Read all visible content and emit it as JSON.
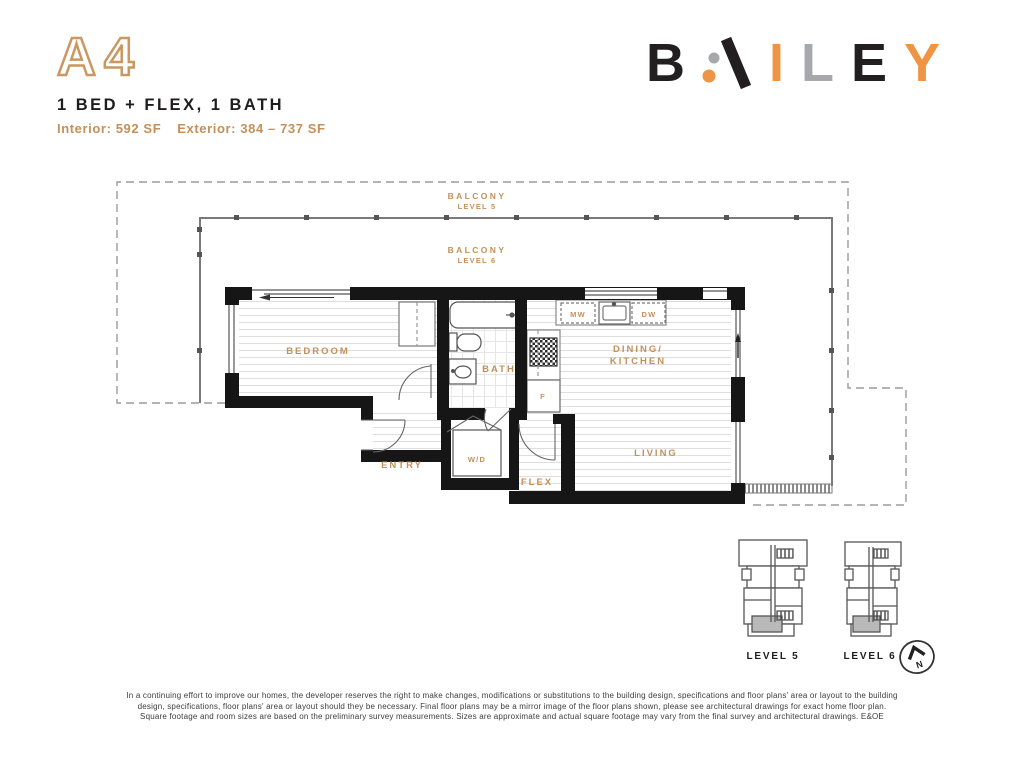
{
  "header": {
    "unit_code": "A4",
    "unit_name": "1 BED + FLEX, 1 BATH",
    "size_interior": "Interior: 592 SF",
    "size_exterior": "Exterior: 384 – 737 SF"
  },
  "logo": {
    "b": "B",
    "a": "A",
    "i": "I",
    "l": "L",
    "e": "E",
    "y": "Y",
    "full_name": "BAILEY"
  },
  "plan": {
    "balcony5_line1": "BALCONY",
    "balcony5_line2": "LEVEL 5",
    "balcony6_line1": "BALCONY",
    "balcony6_line2": "LEVEL 6",
    "bedroom": "BEDROOM",
    "bath": "BATH",
    "dining_line1": "DINING/",
    "dining_line2": "KITCHEN",
    "living": "LIVING",
    "entry": "ENTRY",
    "wd": "W/D",
    "flex": "FLEX",
    "mw": "MW",
    "dw": "DW",
    "fridge": "F"
  },
  "keyplans": {
    "level5": "LEVEL 5",
    "level6": "LEVEL 6",
    "north": "N"
  },
  "disclaimer": {
    "line1": "In a continuing effort to improve our homes, the developer reserves the right to make changes, modifications or substitutions to the building design, specifications and floor plans' area or layout to the building",
    "line2": "design, specifications, floor plans' area or layout should they be necessary. Final floor plans may be a mirror image of the floor plans shown, please see architectural drawings for exact home floor plan.",
    "line3": "Square footage and room sizes are based on the preliminary survey measurements. Sizes are approximate and actual square footage may vary from the final survey and architectural drawings. E&OE"
  },
  "colors": {
    "accent_tan": "#c2915a",
    "logo_orange": "#ee9444",
    "logo_gray": "#a6a8ab",
    "ink": "#231f20",
    "wall": "#161616",
    "keyplan_unit_fill": "#b9b9b9"
  }
}
